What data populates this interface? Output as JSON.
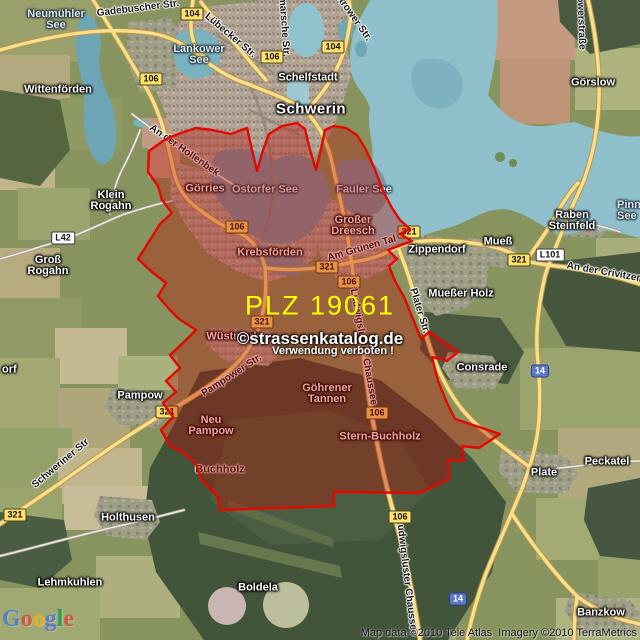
{
  "colors": {
    "overlay_fill": "rgba(186,10,4,0.36)",
    "overlay_stroke": "#e40800",
    "badge_yellow": "#ffe06a",
    "badge_white": "#ffffff",
    "badge_blue": "#5b79c8",
    "plz_color": "#ffff00",
    "water": "#8fbfca"
  },
  "watermarks": {
    "plz": "PLZ 19061",
    "copyright": "©strassenkatalog.de",
    "warning": "Verwendung verboten !"
  },
  "attribution": "Map data ©2010 Tele Atlas  Imagery ©2010 TerraMetrics",
  "logo": {
    "letters": [
      {
        "ch": "G",
        "color": "#4a77d4"
      },
      {
        "ch": "o",
        "color": "#d6492f"
      },
      {
        "ch": "o",
        "color": "#f0b505"
      },
      {
        "ch": "g",
        "color": "#4a77d4"
      },
      {
        "ch": "l",
        "color": "#159a49"
      },
      {
        "ch": "e",
        "color": "#d6492f"
      }
    ]
  },
  "labels": {
    "places": [
      {
        "text": "Wittenförden",
        "x": 58,
        "y": 90
      },
      {
        "text": "Schelfstadt",
        "x": 308,
        "y": 78
      },
      {
        "text": "Schwerin",
        "x": 311,
        "y": 109,
        "size": "big"
      },
      {
        "text": "Görslow",
        "x": 593,
        "y": 83
      },
      {
        "text": "Klein\nRogahn",
        "x": 111,
        "y": 201
      },
      {
        "text": "Groß\nRogahn",
        "x": 48,
        "y": 266
      },
      {
        "text": "Görries",
        "x": 205,
        "y": 189
      },
      {
        "text": "Krebsförden",
        "x": 270,
        "y": 253
      },
      {
        "text": "Großer\nDreesch",
        "x": 353,
        "y": 226
      },
      {
        "text": "Zippendorf",
        "x": 437,
        "y": 250
      },
      {
        "text": "Mueß",
        "x": 498,
        "y": 242
      },
      {
        "text": "Raben\nSteinfeld",
        "x": 572,
        "y": 221
      },
      {
        "text": "Mueßer Holz",
        "x": 461,
        "y": 294
      },
      {
        "text": "Consrade",
        "x": 482,
        "y": 368
      },
      {
        "text": "Wüstmark",
        "x": 233,
        "y": 337
      },
      {
        "text": "Pampow",
        "x": 140,
        "y": 396
      },
      {
        "text": "Neu\nPampow",
        "x": 211,
        "y": 426
      },
      {
        "text": "Buchholz",
        "x": 220,
        "y": 470,
        "style": "dark"
      },
      {
        "text": "Stern-Buchholz",
        "x": 380,
        "y": 437
      },
      {
        "text": "Göhrener\nTannen",
        "x": 327,
        "y": 394
      },
      {
        "text": "Plate",
        "x": 544,
        "y": 473
      },
      {
        "text": "Peckatel",
        "x": 607,
        "y": 462
      },
      {
        "text": "Holthusen",
        "x": 128,
        "y": 518
      },
      {
        "text": "Lehmkuhlen",
        "x": 70,
        "y": 583
      },
      {
        "text": "Boldela",
        "x": 258,
        "y": 588
      },
      {
        "text": "Banzkow",
        "x": 601,
        "y": 613
      },
      {
        "text": "orf",
        "x": 2,
        "y": 370,
        "anchor": "left"
      }
    ],
    "lakes": [
      {
        "text": "Neumühler\nSee",
        "x": 56,
        "y": 20
      },
      {
        "text": "Lankower\nSee",
        "x": 199,
        "y": 55
      },
      {
        "text": "Ostorfer See",
        "x": 265,
        "y": 190
      },
      {
        "text": "Fauler See",
        "x": 364,
        "y": 190
      },
      {
        "text": "Pinnower\nSee",
        "x": 617,
        "y": 211,
        "anchor": "left"
      }
    ],
    "streets": [
      {
        "text": "Gadebuscher Str.",
        "x": 138,
        "y": 9,
        "rot": -7
      },
      {
        "text": "Lübecker Str.",
        "x": 230,
        "y": 36,
        "rot": 40
      },
      {
        "text": "Wismarsche Str.",
        "x": 283,
        "y": 18,
        "rot": 86
      },
      {
        "text": "Güstrower Str.",
        "x": 349,
        "y": 12,
        "rot": 55
      },
      {
        "text": "An der Hollenbek",
        "x": 184,
        "y": 151,
        "rot": 35
      },
      {
        "text": "Görslowerstraße",
        "x": 580,
        "y": 10,
        "rot": 88
      },
      {
        "text": "An der Crivitzer Chaussee",
        "x": 628,
        "y": 277,
        "rot": 10
      },
      {
        "text": "Am Grünen Tal",
        "x": 362,
        "y": 249,
        "rot": -16
      },
      {
        "text": "Pampower Str.",
        "x": 232,
        "y": 376,
        "rot": -33
      },
      {
        "text": "Schweriner Str",
        "x": 61,
        "y": 464,
        "rot": -40
      },
      {
        "text": "Ludwigsluster Chaussee",
        "x": 363,
        "y": 347,
        "rot": 80
      },
      {
        "text": "Ludwigsluster Chaussee",
        "x": 406,
        "y": 577,
        "rot": 83
      },
      {
        "text": "Plater Str.",
        "x": 419,
        "y": 311,
        "rot": 73
      }
    ]
  },
  "badges": [
    {
      "text": "104",
      "x": 192,
      "y": 14,
      "style": "yellow"
    },
    {
      "text": "106",
      "x": 151,
      "y": 79,
      "style": "yellow"
    },
    {
      "text": "106",
      "x": 272,
      "y": 57,
      "style": "yellow"
    },
    {
      "text": "104",
      "x": 333,
      "y": 47,
      "style": "yellow"
    },
    {
      "text": "L42",
      "x": 63,
      "y": 238,
      "style": "white"
    },
    {
      "text": "106",
      "x": 237,
      "y": 227,
      "style": "yellow"
    },
    {
      "text": "321",
      "x": 409,
      "y": 232,
      "style": "yellow"
    },
    {
      "text": "321",
      "x": 327,
      "y": 267,
      "style": "yellow"
    },
    {
      "text": "106",
      "x": 349,
      "y": 282,
      "style": "yellow"
    },
    {
      "text": "321",
      "x": 519,
      "y": 260,
      "style": "yellow"
    },
    {
      "text": "L101",
      "x": 550,
      "y": 255,
      "style": "white"
    },
    {
      "text": "321",
      "x": 262,
      "y": 322,
      "style": "yellow"
    },
    {
      "text": "321",
      "x": 167,
      "y": 412,
      "style": "yellow"
    },
    {
      "text": "106",
      "x": 377,
      "y": 413,
      "style": "yellow"
    },
    {
      "text": "14",
      "x": 540,
      "y": 371,
      "style": "blue"
    },
    {
      "text": "106",
      "x": 400,
      "y": 517,
      "style": "yellow"
    },
    {
      "text": "321",
      "x": 15,
      "y": 515,
      "style": "yellow"
    },
    {
      "text": "14",
      "x": 458,
      "y": 599,
      "style": "blue"
    }
  ]
}
